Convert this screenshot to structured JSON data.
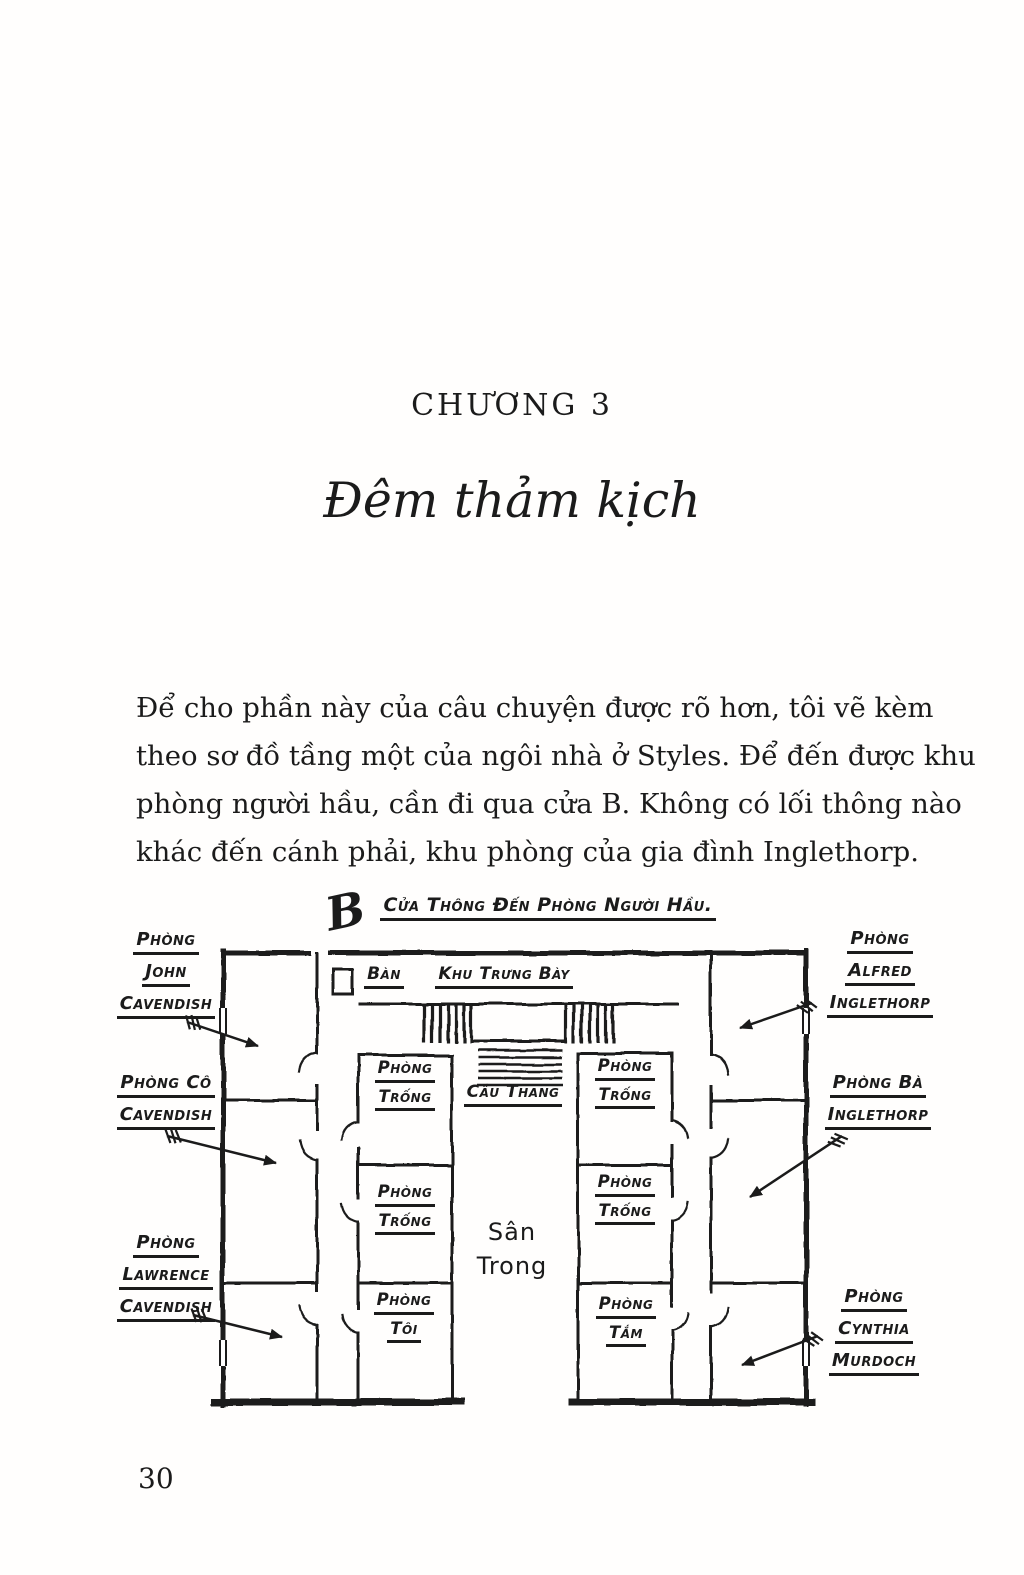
{
  "page": {
    "chapter_heading": "CHƯƠNG 3",
    "chapter_title": "Đêm thảm kịch",
    "paragraph_lines": [
      "Để cho phần này của câu chuyện được rõ hơn, tôi vẽ kèm",
      "theo sơ đồ tầng một của ngôi nhà ở Styles. Để đến được khu",
      "phòng người hầu, cần đi qua cửa B. Không có lối thông nào",
      "khác đến cánh phải, khu phòng của gia đình Inglethorp."
    ],
    "page_number": "30"
  },
  "floorplan": {
    "door_letter": "B",
    "servants_door_label": "Cửa Thông Đến Phòng Người Hầu.",
    "table_label": "Bàn",
    "gallery_label": "Khu Trưng Bày",
    "staircase_label": "Cầu Thang",
    "courtyard": {
      "line1": "Sân",
      "line2": "Trong"
    },
    "outer_rooms_left": [
      {
        "lines": [
          "Phòng",
          "John",
          "Cavendish"
        ]
      },
      {
        "lines": [
          "Phòng Cô",
          "Cavendish"
        ]
      },
      {
        "lines": [
          "Phòng",
          "Lawrence",
          "Cavendish"
        ]
      }
    ],
    "outer_rooms_right": [
      {
        "lines": [
          "Phòng",
          "Alfred",
          "Inglethorp"
        ]
      },
      {
        "lines": [
          "Phòng Bà",
          "Inglethorp"
        ]
      },
      {
        "lines": [
          "Phòng",
          "Cynthia",
          "Murdoch"
        ]
      }
    ],
    "empty_room_label": [
      "Phòng",
      "Trống"
    ],
    "my_room_label": [
      "Phòng",
      "Tôi"
    ],
    "bathroom_label": [
      "Phòng",
      "Tắm"
    ],
    "ink_color": "#1b1b1b"
  }
}
